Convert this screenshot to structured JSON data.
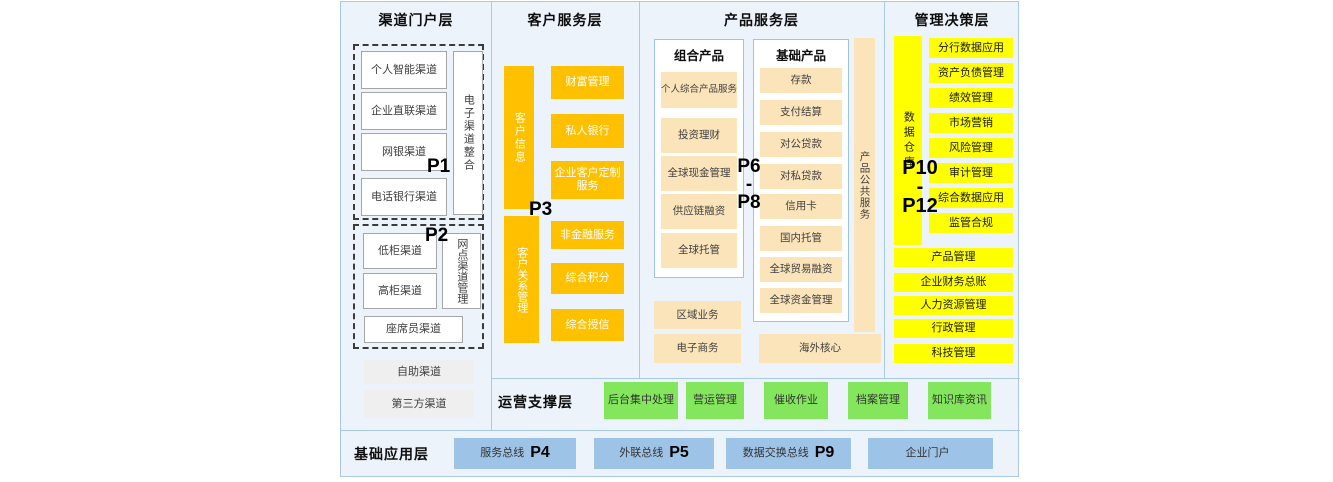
{
  "colors": {
    "background": "#edf3fa",
    "border_blue": "#aac9e8",
    "orange": "#ffc000",
    "cream": "#fce4ba",
    "yellow": "#ffff00",
    "green": "#84e65c",
    "blue_box": "#9dc3e6"
  },
  "channel": {
    "title": "渠道门户层",
    "p1_label": "P1",
    "p1_items": [
      "个人智能渠道",
      "企业直联渠道",
      "网银渠道",
      "电话银行渠道"
    ],
    "p1_side": "电子渠道整合",
    "p2_label": "P2",
    "p2_items": [
      "低柜渠道",
      "高柜渠道"
    ],
    "p2_side": "网点渠道管理",
    "p2_wide": "座席员渠道",
    "extra": [
      "自助渠道",
      "第三方渠道"
    ]
  },
  "customer": {
    "title": "客户服务层",
    "p3_label": "P3",
    "top_bar": "客户信息",
    "top_items": [
      "财富管理",
      "私人银行",
      "企业客户定制服务"
    ],
    "bottom_bar": "客户关系管理",
    "bottom_items": [
      "非金融服务",
      "综合积分",
      "综合授信"
    ]
  },
  "product": {
    "title": "产品服务层",
    "p_top": "P6",
    "p_mid": "-",
    "p_bottom": "P8",
    "combo_title": "组合产品",
    "combo_items": [
      "个人综合产品服务",
      "投资理财",
      "全球现金管理",
      "供应链融资",
      "全球托管"
    ],
    "basic_title": "基础产品",
    "basic_items": [
      "存款",
      "支付结算",
      "对公贷款",
      "对私贷款",
      "信用卡",
      "国内托管",
      "全球贸易融资",
      "全球资金管理"
    ],
    "side_bar": "产品公共服务",
    "bottom_items": [
      "区域业务",
      "电子商务"
    ],
    "overseas": "海外核心"
  },
  "management": {
    "title": "管理决策层",
    "p_top": "P10",
    "p_mid": "-",
    "p_bottom": "P12",
    "side_bar": "数据仓库",
    "items": [
      "分行数据应用",
      "资产负债管理",
      "绩效管理",
      "市场营销",
      "风险管理",
      "审计管理",
      "综合数据应用",
      "监管合规"
    ],
    "wide_items": [
      "产品管理",
      "企业财务总账",
      "人力资源管理",
      "行政管理",
      "科技管理"
    ]
  },
  "operation": {
    "title": "运营支撑层",
    "items": [
      "后台集中处理",
      "营运管理",
      "催收作业",
      "档案管理",
      "知识库资讯"
    ]
  },
  "foundation": {
    "title": "基础应用层",
    "buses": [
      {
        "label": "服务总线",
        "p": "P4"
      },
      {
        "label": "外联总线",
        "p": "P5"
      },
      {
        "label": "数据交换总线",
        "p": "P9"
      },
      {
        "label": "企业门户",
        "p": ""
      }
    ]
  }
}
